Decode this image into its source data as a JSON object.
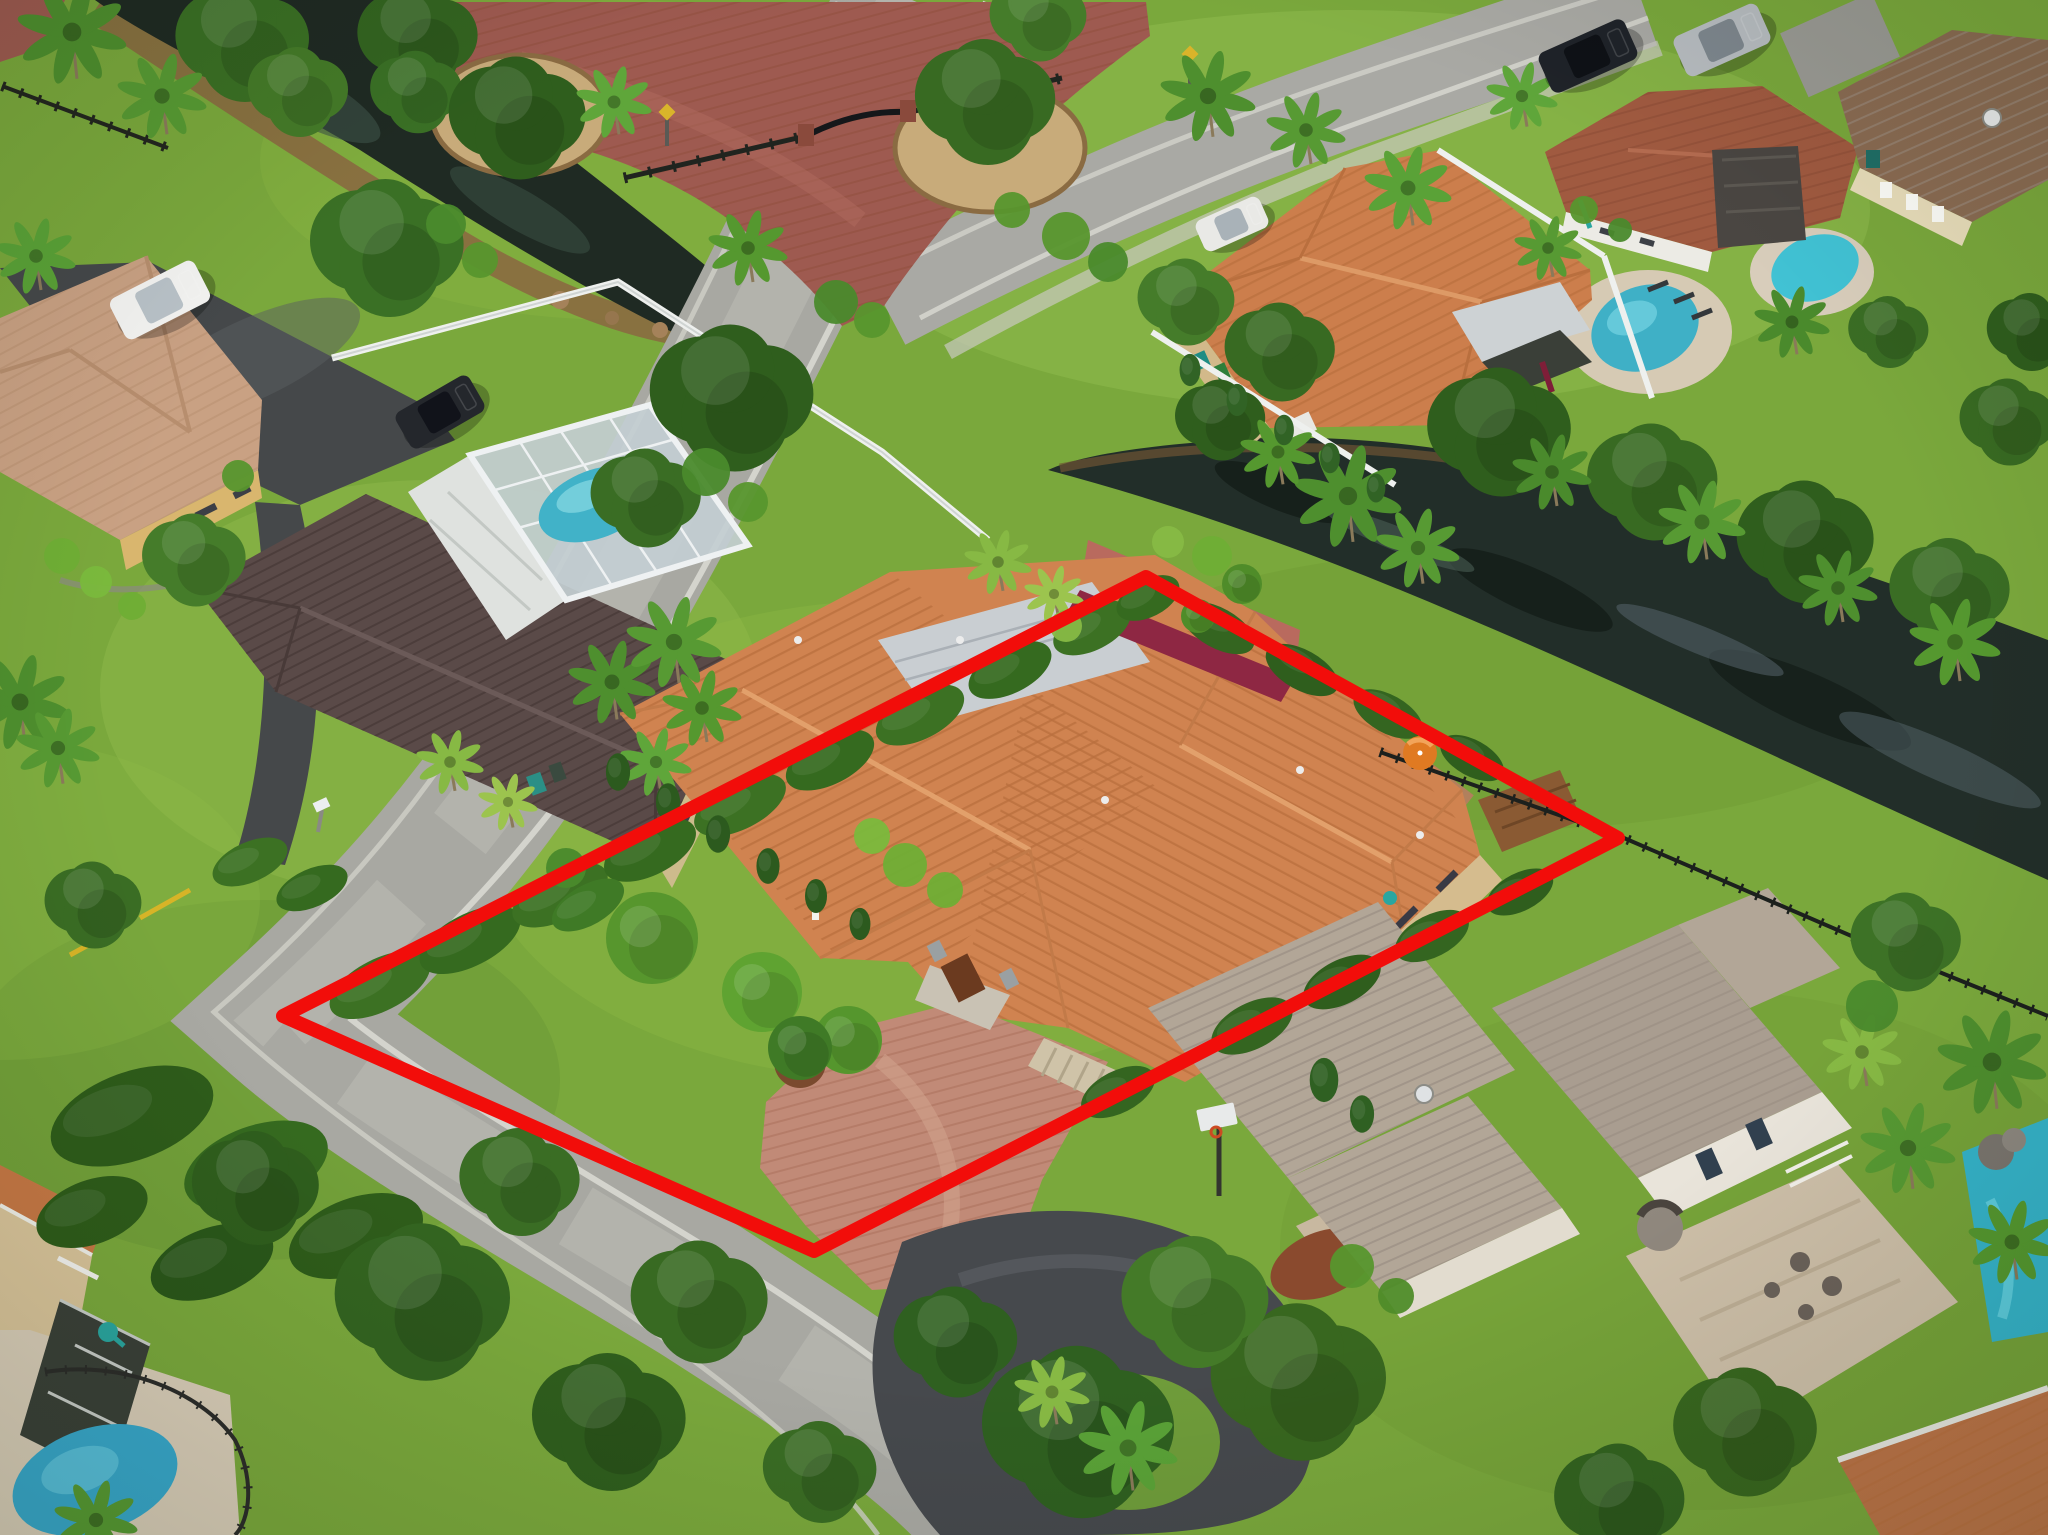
{
  "image": {
    "type": "aerial-drone-photograph",
    "alt": "Aerial drone photo of a suburban Florida neighborhood with a red property-boundary outline drawn around a single-family home with an orange barrel-tile roof, palm trees, paver driveway, canal behind the lot, neighboring houses with pools and a road curving past the front of the property",
    "width": 2048,
    "height": 1535
  },
  "overlay": {
    "name": "property-boundary",
    "boundary_color": "#f20d0a",
    "boundary_stroke_width": 14,
    "boundary_points": [
      [
        283,
        1016
      ],
      [
        1146,
        577
      ],
      [
        1618,
        838
      ],
      [
        814,
        1251
      ]
    ]
  },
  "palette": {
    "grass": "#7aa83c",
    "grass_light": "#a3cb5f",
    "grass_dark": "#547f2b",
    "road": "#a8a8a2",
    "road_worn": "#bcbcb4",
    "asphalt_dark": "#45484a",
    "estate_pavers": "#9e5a50",
    "subject_roof": "#d08350",
    "subject_roof_line": "#b96f3e",
    "flat_roof_silver": "#c9ced2",
    "awning_maroon": "#8e2743",
    "neighbor_roof_brown": "#5a4a48",
    "modern_roof_taupe": "#b2a697",
    "tile_roof_red": "#a05a40",
    "walls_tan": "#d5bc8e",
    "pool_blue": "#3fb0c6",
    "canal_water": "#202b24",
    "white_fence": "#eef0ee",
    "black_fence": "#23261f",
    "driveway_pavers": "#c18a77"
  },
  "scene": {
    "houses": [
      {
        "name": "subject-home",
        "roof": "orange-barrel-tile",
        "inside_boundary": true
      },
      {
        "name": "left-neighbor-with-screened-pool",
        "roof": "dark-brown-metal"
      },
      {
        "name": "top-left-tan-house",
        "roof": "pale-tile"
      },
      {
        "name": "top-right-orange-tile-house",
        "roof": "orange-tile"
      },
      {
        "name": "top-right-brown-tile-house-with-pool",
        "roof": "red-brown-tile"
      },
      {
        "name": "far-top-right-yellow-house",
        "roof": "brown-tile"
      },
      {
        "name": "bottom-right-two-story-modern",
        "roof": "taupe-metal"
      },
      {
        "name": "bottom-left-house-with-kidney-pool",
        "roof": "orange-tile"
      }
    ],
    "water": [
      "canal-top-left",
      "canal-right"
    ],
    "pools": [
      {
        "name": "screened-pool-left-neighbor",
        "x": 596,
        "y": 504
      },
      {
        "name": "pool-top-right-house",
        "x": 1645,
        "y": 328
      },
      {
        "name": "pool-far-right-house",
        "x": 1815,
        "y": 268
      },
      {
        "name": "pool-bottom-right-modern",
        "x": 2005,
        "y": 1230
      },
      {
        "name": "kidney-pool-bottom-left",
        "x": 95,
        "y": 1480
      }
    ],
    "vehicles": [
      [
        160,
        300,
        95,
        46,
        -27,
        "#f3f3f1",
        "#b9c2c8"
      ],
      [
        440,
        412,
        85,
        42,
        -30,
        "#24272c",
        "#11131a"
      ],
      [
        1588,
        56,
        94,
        44,
        -24,
        "#1f2329",
        "#0e1116"
      ],
      [
        1722,
        40,
        92,
        44,
        -24,
        "#b7bcc0",
        "#7e878e"
      ],
      [
        1232,
        224,
        70,
        34,
        -24,
        "#e9e9e6",
        "#a9b2b8"
      ]
    ],
    "oaks": [
      [
        245,
        42,
        80,
        "#3a6f24"
      ],
      [
        420,
        38,
        72,
        "#336420"
      ],
      [
        300,
        92,
        60,
        "#447a28"
      ],
      [
        418,
        92,
        55,
        "#3a7025"
      ],
      [
        520,
        118,
        82,
        "#2f5e1d"
      ],
      [
        988,
        102,
        84,
        "#386a22"
      ],
      [
        1040,
        18,
        58,
        "#457c2a"
      ],
      [
        390,
        248,
        92,
        "#3a7025"
      ],
      [
        735,
        398,
        98,
        "#2f5e1d"
      ],
      [
        648,
        498,
        66,
        "#3a6d24"
      ],
      [
        196,
        560,
        62,
        "#457c2a"
      ],
      [
        95,
        905,
        58,
        "#3a6d24"
      ],
      [
        1188,
        302,
        58,
        "#457c2a"
      ],
      [
        1282,
        352,
        66,
        "#386a22"
      ],
      [
        1222,
        420,
        54,
        "#2f5e1d"
      ],
      [
        1502,
        432,
        86,
        "#2f5e1d"
      ],
      [
        1655,
        482,
        78,
        "#386a22"
      ],
      [
        1808,
        542,
        82,
        "#2f5e1d"
      ],
      [
        1952,
        592,
        72,
        "#3a6d24"
      ],
      [
        2010,
        422,
        58,
        "#386a22"
      ],
      [
        2032,
        332,
        52,
        "#2f5e1d"
      ],
      [
        1890,
        332,
        48,
        "#3a6d24"
      ],
      [
        426,
        1302,
        105,
        "#336420"
      ],
      [
        612,
        1422,
        92,
        "#2f5e1d"
      ],
      [
        522,
        1182,
        72,
        "#3a6d24"
      ],
      [
        702,
        1302,
        82,
        "#386a22"
      ],
      [
        258,
        1188,
        76,
        "#2f5e1d"
      ],
      [
        1082,
        1432,
        115,
        "#2f6020"
      ],
      [
        1302,
        1382,
        105,
        "#38671f"
      ],
      [
        1198,
        1302,
        88,
        "#447a28"
      ],
      [
        958,
        1342,
        74,
        "#2f6020"
      ],
      [
        822,
        1472,
        68,
        "#3a6d24"
      ],
      [
        1622,
        1502,
        78,
        "#336420"
      ],
      [
        1748,
        1432,
        86,
        "#38671f"
      ],
      [
        1908,
        942,
        66,
        "#3d7226"
      ]
    ],
    "palms": [
      [
        72,
        32,
        55,
        "#4e8f2e"
      ],
      [
        162,
        96,
        45,
        "#579a33"
      ],
      [
        36,
        256,
        40,
        "#5aa237"
      ],
      [
        20,
        702,
        50,
        "#4e8f2e"
      ],
      [
        58,
        748,
        42,
        "#579a33"
      ],
      [
        614,
        102,
        38,
        "#5fa63a"
      ],
      [
        748,
        248,
        40,
        "#55982f"
      ],
      [
        1208,
        96,
        48,
        "#4e8f2e"
      ],
      [
        1306,
        130,
        40,
        "#579a33"
      ],
      [
        1408,
        188,
        44,
        "#5aa237"
      ],
      [
        1522,
        96,
        36,
        "#5fa63a"
      ],
      [
        998,
        562,
        34,
        "#87b944"
      ],
      [
        1054,
        594,
        30,
        "#9cc44e"
      ],
      [
        1348,
        496,
        54,
        "#4e8f2e"
      ],
      [
        1418,
        548,
        42,
        "#579a33"
      ],
      [
        1278,
        452,
        38,
        "#55982f"
      ],
      [
        1552,
        472,
        40,
        "#4a8a2c"
      ],
      [
        1702,
        522,
        44,
        "#579a33"
      ],
      [
        1838,
        588,
        40,
        "#4e8f2e"
      ],
      [
        1955,
        642,
        46,
        "#55982f"
      ],
      [
        1992,
        1062,
        55,
        "#4e8f2e"
      ],
      [
        1908,
        1148,
        48,
        "#579a33"
      ],
      [
        2012,
        1242,
        44,
        "#55982f"
      ],
      [
        1862,
        1052,
        40,
        "#87b944"
      ],
      [
        1128,
        1448,
        50,
        "#5aa237"
      ],
      [
        1052,
        1392,
        38,
        "#87b944"
      ],
      [
        612,
        682,
        44,
        "#4e8f2e"
      ],
      [
        674,
        642,
        48,
        "#579a33"
      ],
      [
        702,
        708,
        40,
        "#55982f"
      ],
      [
        656,
        762,
        36,
        "#5fa63a"
      ],
      [
        450,
        762,
        34,
        "#87b944"
      ],
      [
        508,
        802,
        30,
        "#9cc44e"
      ],
      [
        1548,
        248,
        34,
        "#579a33"
      ],
      [
        1792,
        322,
        38,
        "#4a8a2c"
      ],
      [
        96,
        1520,
        42,
        "#579a33"
      ]
    ],
    "cones": [
      [
        618,
        772,
        22,
        "#2c5a1e"
      ],
      [
        668,
        802,
        22,
        "#2c5a1e"
      ],
      [
        718,
        834,
        22,
        "#2c5a1e"
      ],
      [
        768,
        866,
        21,
        "#2c5a1e"
      ],
      [
        816,
        896,
        20,
        "#2c5a1e"
      ],
      [
        860,
        924,
        19,
        "#2c5a1e"
      ],
      [
        1190,
        370,
        19,
        "#316325"
      ],
      [
        1237,
        400,
        19,
        "#316325"
      ],
      [
        1284,
        430,
        18,
        "#316325"
      ],
      [
        1330,
        458,
        18,
        "#316325"
      ],
      [
        1376,
        488,
        17,
        "#316325"
      ],
      [
        1324,
        1080,
        26,
        "#2f6022"
      ],
      [
        1362,
        1114,
        22,
        "#2f6022"
      ]
    ],
    "balls": [
      [
        652,
        938,
        46,
        "#57962d"
      ],
      [
        762,
        992,
        40,
        "#5fa331"
      ],
      [
        848,
        1040,
        34,
        "#55962d"
      ],
      [
        1242,
        584,
        20,
        "#4f8c29"
      ],
      [
        1198,
        616,
        17,
        "#4f8c29"
      ],
      [
        800,
        1048,
        32,
        "#3f7a26"
      ]
    ],
    "bushes": [
      [
        905,
        865,
        22,
        "#6fae35"
      ],
      [
        945,
        890,
        18,
        "#6fae35"
      ],
      [
        872,
        836,
        18,
        "#7ab93c"
      ],
      [
        1212,
        556,
        20,
        "#6fae35"
      ],
      [
        1168,
        542,
        16,
        "#87b944"
      ],
      [
        1066,
        626,
        16,
        "#87b944"
      ],
      [
        706,
        472,
        24,
        "#4a8a2c"
      ],
      [
        748,
        502,
        20,
        "#57962d"
      ],
      [
        1066,
        236,
        24,
        "#57962d"
      ],
      [
        1108,
        262,
        20,
        "#4a8a2c"
      ],
      [
        1012,
        210,
        18,
        "#57962d"
      ],
      [
        446,
        224,
        20,
        "#4a8a2c"
      ],
      [
        480,
        260,
        18,
        "#57962d"
      ],
      [
        62,
        556,
        18,
        "#6fae35"
      ],
      [
        96,
        582,
        16,
        "#7ab93c"
      ],
      [
        132,
        606,
        14,
        "#6fae35"
      ],
      [
        238,
        476,
        16,
        "#57962d"
      ],
      [
        1352,
        1266,
        22,
        "#57962d"
      ],
      [
        1396,
        1296,
        18,
        "#4f8c29"
      ],
      [
        1872,
        1006,
        26,
        "#4a8a2c"
      ],
      [
        566,
        868,
        20,
        "#4a8a2c"
      ],
      [
        836,
        302,
        22,
        "#4a8a2c"
      ],
      [
        872,
        320,
        18,
        "#57962d"
      ],
      [
        1584,
        210,
        14,
        "#57962d"
      ],
      [
        1620,
        230,
        12,
        "#4a8a2c"
      ]
    ],
    "hedges": [
      [
        380,
        985,
        55,
        26,
        -27,
        "#3c7123"
      ],
      [
        470,
        940,
        55,
        26,
        -27,
        "#356a1f"
      ],
      [
        560,
        895,
        52,
        25,
        -27,
        "#3c7123"
      ],
      [
        650,
        850,
        50,
        25,
        -27,
        "#356a1f"
      ],
      [
        740,
        805,
        50,
        24,
        -27,
        "#3c7123"
      ],
      [
        830,
        760,
        48,
        24,
        -27,
        "#356a1f"
      ],
      [
        920,
        715,
        48,
        24,
        -27,
        "#3c7123"
      ],
      [
        1010,
        670,
        45,
        23,
        -27,
        "#356a1f"
      ],
      [
        1092,
        628,
        42,
        22,
        -27,
        "#3c7123"
      ],
      [
        1148,
        598,
        34,
        19,
        -27,
        "#356a1f"
      ],
      [
        1218,
        628,
        40,
        20,
        29,
        "#346520"
      ],
      [
        1302,
        670,
        40,
        20,
        29,
        "#2f5e1d"
      ],
      [
        1388,
        714,
        38,
        19,
        29,
        "#346520"
      ],
      [
        1472,
        758,
        35,
        18,
        29,
        "#2f5e1d"
      ],
      [
        1252,
        1026,
        44,
        23,
        -27,
        "#346520"
      ],
      [
        1342,
        982,
        42,
        22,
        -27,
        "#2f5e1d"
      ],
      [
        1432,
        936,
        40,
        21,
        -27,
        "#346520"
      ],
      [
        1520,
        892,
        36,
        19,
        -27,
        "#2f5e1d"
      ],
      [
        1118,
        1092,
        40,
        21,
        -27,
        "#346520"
      ],
      [
        132,
        1116,
        85,
        44,
        -20,
        "#2e5c1a"
      ],
      [
        256,
        1166,
        75,
        40,
        -20,
        "#356a1f"
      ],
      [
        356,
        1236,
        70,
        38,
        -20,
        "#2e5c1a"
      ],
      [
        212,
        1262,
        64,
        34,
        -20,
        "#2a571a"
      ],
      [
        92,
        1212,
        58,
        32,
        -20,
        "#2e5c1a"
      ],
      [
        588,
        905,
        40,
        20,
        -30,
        "#3f7a26"
      ],
      [
        250,
        862,
        40,
        20,
        -24,
        "#3c7123"
      ],
      [
        312,
        888,
        38,
        19,
        -24,
        "#356a1f"
      ]
    ]
  }
}
